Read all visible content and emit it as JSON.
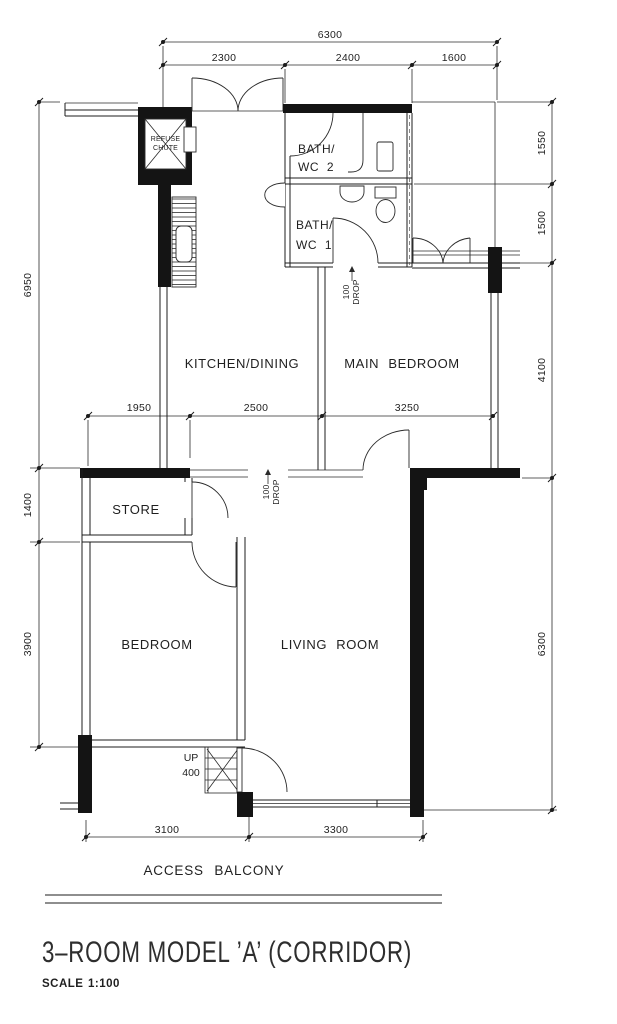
{
  "drawing": {
    "title": "3–ROOM MODEL ’A’ (CORRIDOR)",
    "scale_label": "SCALE",
    "scale_value": "1:100"
  },
  "rooms": {
    "kitchen_dining": "KITCHEN/DINING",
    "main_bedroom": "MAIN BEDROOM",
    "living_room": "LIVING ROOM",
    "bedroom": "BEDROOM",
    "store": "STORE",
    "bath_wc_2": {
      "line1": "BATH/",
      "line2": "WC 2"
    },
    "bath_wc_1": {
      "line1": "BATH/",
      "line2": "WC 1"
    },
    "refuse_chute": {
      "line1": "REFUSE",
      "line2": "CHUTE"
    }
  },
  "annotations": {
    "access_balcony": "ACCESS BALCONY",
    "up_label": "UP",
    "up_value": "400",
    "drop_kitchen": {
      "line1": "100",
      "line2": "DROP"
    },
    "drop_bath": {
      "line1": "100",
      "line2": "DROP"
    }
  },
  "dimensions": {
    "top_total": "6300",
    "top_segments": [
      "2300",
      "2400",
      "1600"
    ],
    "left": [
      "6950",
      "1400",
      "3900"
    ],
    "right": [
      "1550",
      "1500",
      "4100",
      "6300"
    ],
    "middle": [
      "1950",
      "2500",
      "3250"
    ],
    "bottom": [
      "3100",
      "3300"
    ]
  },
  "colors": {
    "ink": "#1c1c1c",
    "paper": "#ffffff"
  }
}
